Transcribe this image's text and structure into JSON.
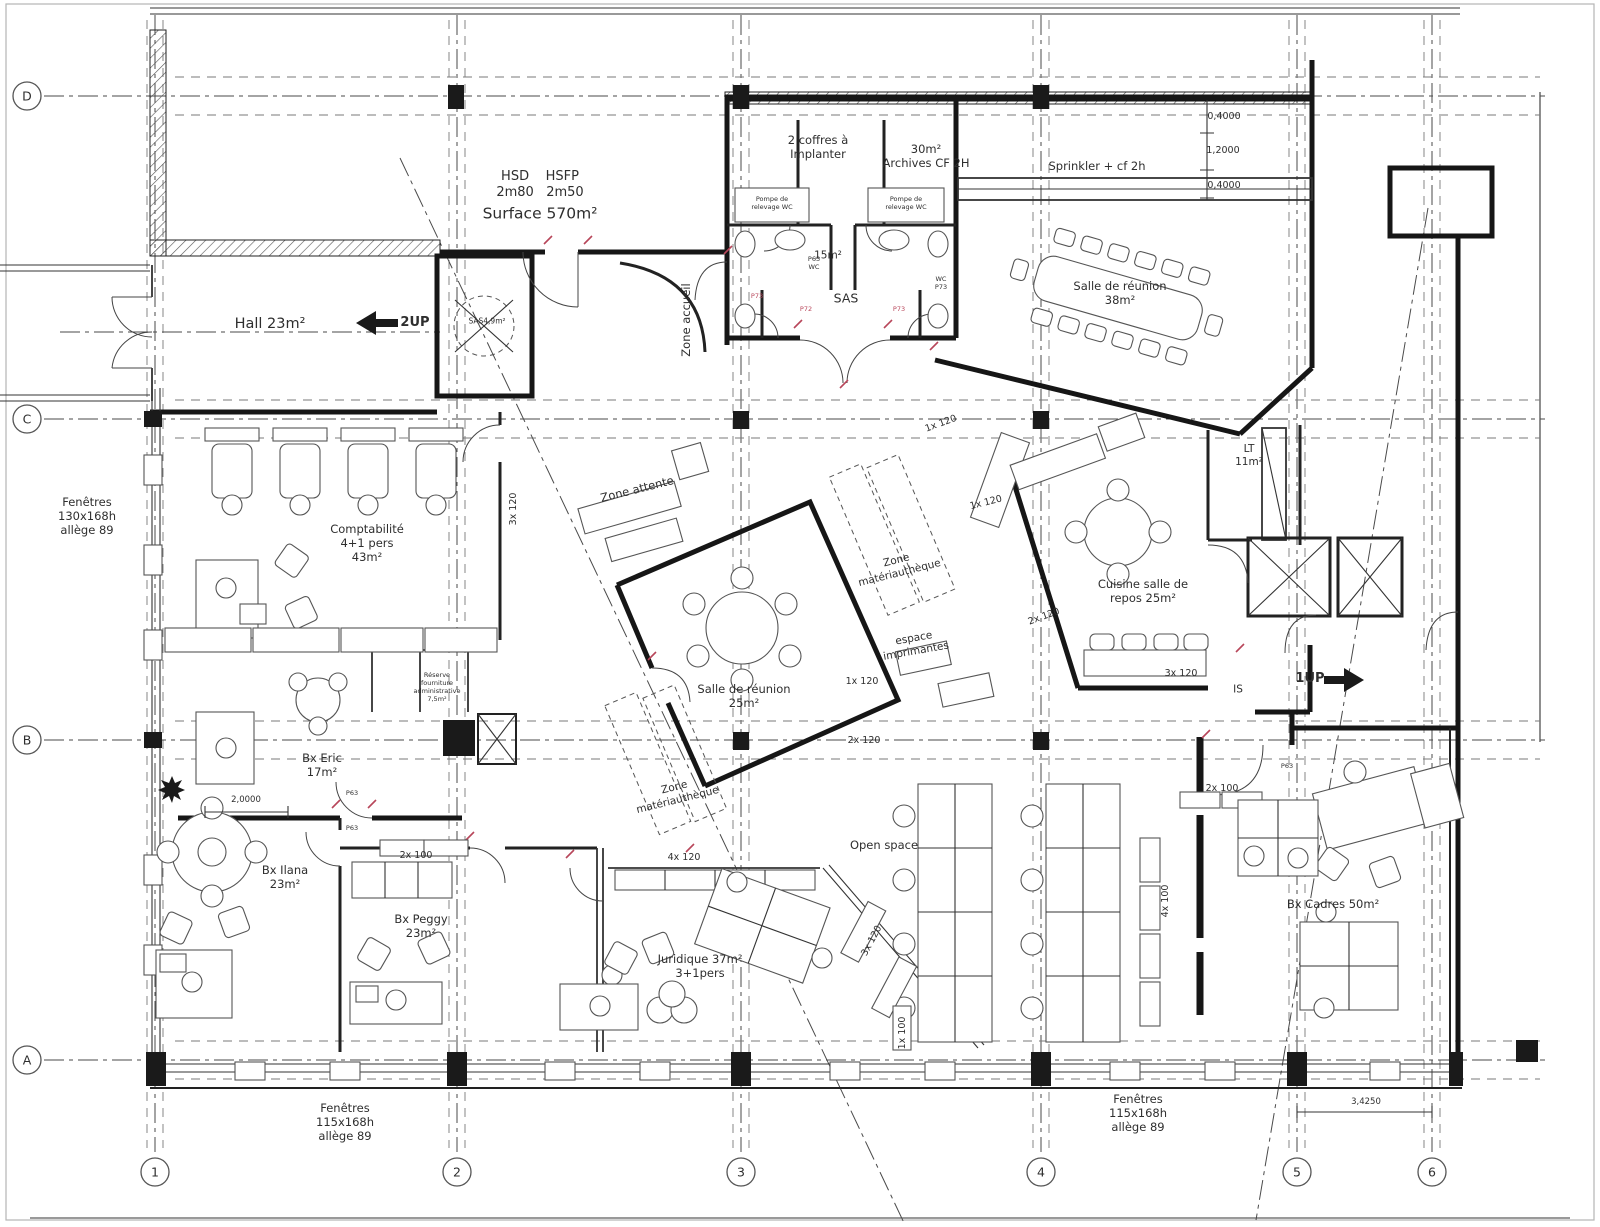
{
  "grid": {
    "rows": [
      {
        "label": "D"
      },
      {
        "label": "C"
      },
      {
        "label": "B"
      },
      {
        "label": "A"
      }
    ],
    "cols": [
      {
        "label": "1"
      },
      {
        "label": "2"
      },
      {
        "label": "3"
      },
      {
        "label": "4"
      },
      {
        "label": "5"
      },
      {
        "label": "6"
      }
    ]
  },
  "areas": {
    "spec": "HSD    HSFP\n2m80   2m50",
    "surface": "Surface 570m²",
    "hall": "Hall 23m²",
    "sas_hall": "SAS4,9m²",
    "zone_accueil": "Zone accueil",
    "coffres": "2 coffres à\nImplanter",
    "archives": "30m²\nArchives CF 2H",
    "sprinkler": "Sprinkler + cf 2h",
    "wc_area": "15m²",
    "wc_sas": "SAS",
    "pompe_left": "Pompe de\nrelevage WC",
    "pompe_right": "Pompe de\nrelevage WC",
    "reunion38": "Salle de réunion\n38m²",
    "compta": "Comptabilité\n4+1 pers\n43m²",
    "zone_attente": "Zone attente",
    "zone_mat_1": "Zone\nmatériauthèque",
    "zone_mat_2": "Zone\nmatériauthèque",
    "espace_imprimantes": "espace\nimprimantes",
    "reunion25": "Salle de réunion\n25m²",
    "cuisine": "Cuisine salle de\nrepos 25m²",
    "lt": "LT\n11m²",
    "is": "IS",
    "reserve": "Réserve\nfourniture\nadministrative\n7,5m²",
    "bx_eric": "Bx Eric\n17m²",
    "bx_ilana": "Bx Ilana\n23m²",
    "bx_peggy": "Bx Peggy\n23m²",
    "juridique": "Juridique 37m²\n3+1pers",
    "open_space": "Open space",
    "bx_cadres": "Bx Cadres 50m²"
  },
  "cabinets": {
    "a3x120": "3x 120",
    "b1x120": "1x 120",
    "c1x120": "1x 120",
    "d1x120": "1x 120",
    "e2x120": "2x 120",
    "f2x120": "2x 120",
    "g3x120": "3x 120",
    "h4x120": "4x 120",
    "i2x100": "2x 100",
    "j3x120": "3x 120",
    "k1x100": "1x 100",
    "l2x100": "2x 100",
    "m4x100": "4x 100"
  },
  "dimensions": {
    "top_a": "0,4000",
    "top_b": "1,2000",
    "top_c": "0,4000",
    "ilana": "2,0000",
    "right": "3,4250"
  },
  "windows": {
    "left": "Fenêtres\n130x168h\nallège 89",
    "bottom_left": "Fenêtres\n115x168h\nallège 89",
    "bottom_right": "Fenêtres\n115x168h\nallège 89"
  },
  "stairs": {
    "up2": "2UP",
    "up1": "1UP"
  },
  "door_codes": {
    "p63_wc_left": "P63\nWC",
    "p73_wc_right": "WC\nP73",
    "p73_red_left": "P73",
    "p72_red_left": "P72",
    "p73_red_right": "P73",
    "p63_eric_top": "P63",
    "p63_eric_bottom": "P63",
    "p63_is": "P63"
  }
}
